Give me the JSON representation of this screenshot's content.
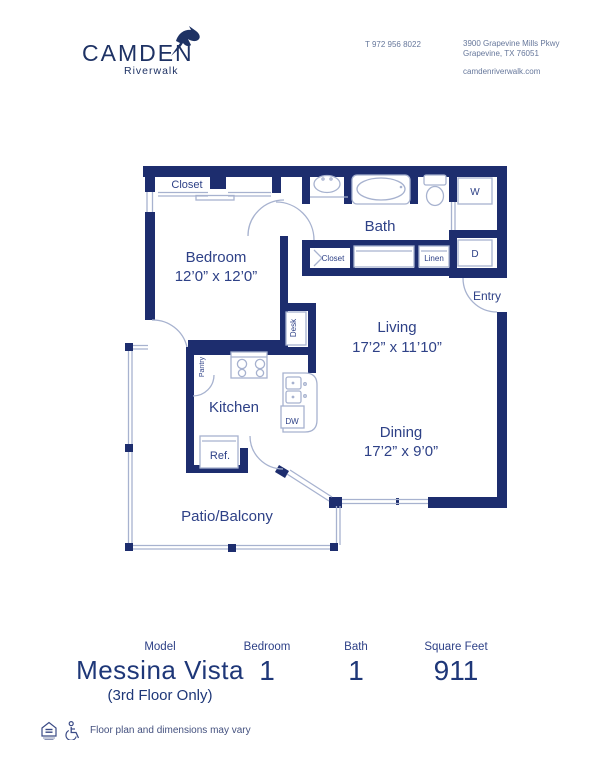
{
  "brand": {
    "name": "CAMDEN",
    "community": "Riverwalk"
  },
  "contact": {
    "phone": "T 972 956 8022",
    "address_line1": "3900 Grapevine Mills Pkwy",
    "address_line2": "Grapevine, TX 76051",
    "website": "camdenriverwalk.com"
  },
  "floorplan": {
    "rooms": {
      "bedroom": {
        "name": "Bedroom",
        "dims": "12’0” x 12’0”"
      },
      "living": {
        "name": "Living",
        "dims": "17’2” x 11’10”"
      },
      "dining": {
        "name": "Dining",
        "dims": "17’2” x 9’0”"
      },
      "kitchen": {
        "name": "Kitchen"
      },
      "bath": {
        "name": "Bath"
      },
      "patio": {
        "name": "Patio/Balcony"
      },
      "entry": {
        "name": "Entry"
      }
    },
    "features": {
      "closet_bedroom": "Closet",
      "closet_hall": "Closet",
      "linen": "Linen",
      "pantry": "Pantry",
      "desk": "Desk",
      "washer": "W",
      "dryer": "D",
      "refrigerator": "Ref.",
      "dishwasher": "DW"
    }
  },
  "summary": {
    "model": {
      "label": "Model",
      "value": "Messina Vista",
      "note": "(3rd Floor Only)"
    },
    "bedroom": {
      "label": "Bedroom",
      "value": "1"
    },
    "bath": {
      "label": "Bath",
      "value": "1"
    },
    "sqft": {
      "label": "Square Feet",
      "value": "911"
    }
  },
  "disclaimer": "Floor plan and dimensions may vary",
  "colors": {
    "wall": "#1d2d6e",
    "label": "#2e4187",
    "fixture": "#a7b2cf",
    "text_dark": "#1e3778"
  }
}
